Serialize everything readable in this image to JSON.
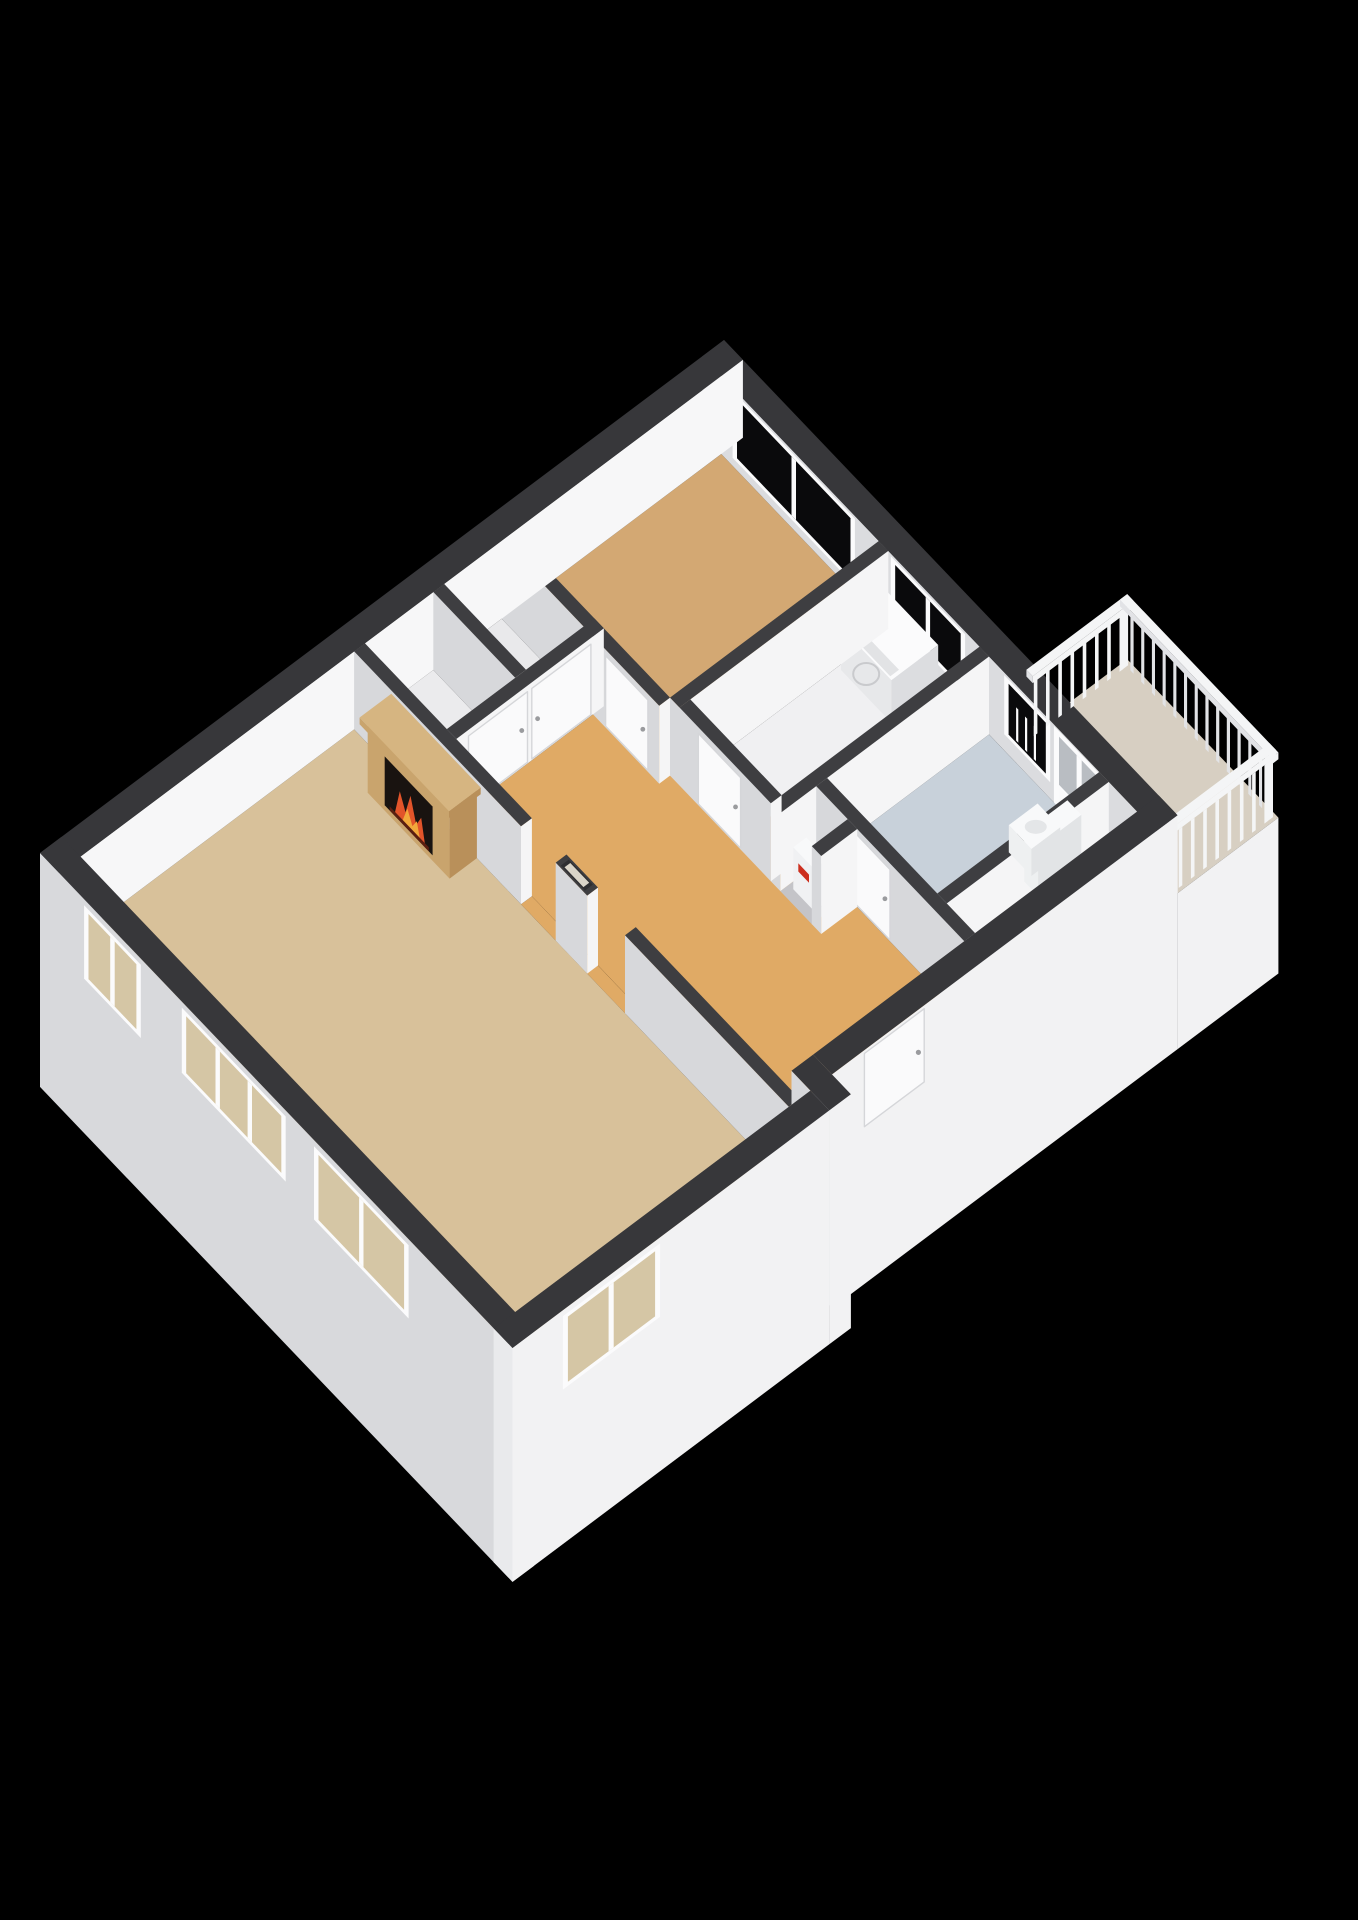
{
  "canvas": {
    "width": 1358,
    "height": 1920,
    "background": "#000000"
  },
  "scene_type": "isometric-3d-floor-plan",
  "palette": {
    "bg": "#000000",
    "wallTopOuter": "#37373a",
    "wallTopInner": "#3e3e41",
    "faceBrightS": "#f5f5f6",
    "faceMedW": "#d7d8db",
    "nwInner": "#f7f7f8",
    "neInner": "#dbdcdf",
    "skirtSW": "#d8d9dc",
    "skirtSE": "#f2f2f3",
    "endCap": "#e9eaec",
    "glassDark": "#0a0a0c",
    "glassBeige": "#d5c6a5",
    "glassDoor": "#b9bdc2",
    "frame": "#fbfbfc",
    "door": "#fafafb",
    "doorEdge": "#d5d6d9",
    "handle": "#9a9b9e",
    "fireplaceFace": "#c9a46d",
    "fireplaceSide": "#b9905a",
    "fireplaceTop": "#d6b581",
    "firebox": "#191310",
    "flameOrange": "#e2542a",
    "flameYellow": "#f2a83b",
    "applianceFront": "#e7e8ea",
    "applianceSide": "#dcdde0",
    "applianceTop": "#fbfbfc",
    "railing": "#f4f5f6",
    "railingShade": "#e2e3e6",
    "columnHole": "#d9d4c8",
    "columnHoleRim": "#2e2e31",
    "meterRed": "#cc2f1e",
    "toiletBody": "#eef0f1",
    "toiletSide": "#e2e4e6",
    "toiletTop": "#f8f9fa"
  },
  "rooms": [
    {
      "id": "living-room",
      "floor_color": "#d8c19a"
    },
    {
      "id": "bedroom",
      "floor_color": "#d3a873"
    },
    {
      "id": "hallway",
      "floor_color": "#e0aa65"
    },
    {
      "id": "storage-a",
      "floor_color": "#ebebed"
    },
    {
      "id": "storage-b",
      "floor_color": "#e9e9eb"
    },
    {
      "id": "laundry-room",
      "floor_color": "#f0f0f2"
    },
    {
      "id": "shaft",
      "floor_color": "#c4c4c8"
    },
    {
      "id": "bathroom",
      "floor_color": "#c8d1da"
    },
    {
      "id": "wc",
      "floor_color": "#ededef"
    },
    {
      "id": "balcony",
      "floor_color": "#d7cfc2"
    }
  ],
  "fixtures": [
    {
      "id": "fireplace"
    },
    {
      "id": "chimney-column"
    },
    {
      "id": "washing-machine"
    },
    {
      "id": "toilet"
    },
    {
      "id": "meter-box"
    },
    {
      "id": "balcony-railing"
    },
    {
      "id": "entrance-door"
    },
    {
      "id": "balcony-door"
    }
  ],
  "window_count": 8,
  "interior_door_count": 5
}
